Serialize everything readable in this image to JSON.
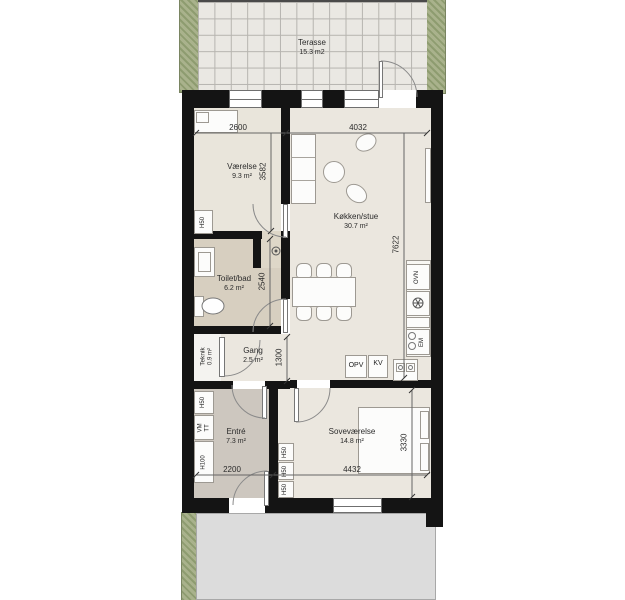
{
  "terrace": {
    "name": "Terasse",
    "area": "15.3 m2"
  },
  "rooms": {
    "vaerelse": {
      "name": "Værelse",
      "area": "9.3 m²"
    },
    "koekken": {
      "name": "Køkken/stue",
      "area": "30.7 m²"
    },
    "toilet": {
      "name": "Toilet/bad",
      "area": "6.2 m²"
    },
    "teknik": {
      "name": "Teknik",
      "area": "0.9 m²"
    },
    "gang": {
      "name": "Gang",
      "area": "2.5 m²"
    },
    "entre": {
      "name": "Entré",
      "area": "7.3 m²"
    },
    "sovevaerelse": {
      "name": "Soveværelse",
      "area": "14.8 m²"
    }
  },
  "dims": {
    "d2600": "2600",
    "d3582": "3582",
    "d4032": "4032",
    "d7622": "7622",
    "d2540": "2540",
    "d1300": "1300",
    "d2200": "2200",
    "d4432": "4432",
    "d3330": "3330"
  },
  "fixtures": {
    "h50": "H50",
    "h100": "H100",
    "vm": "VM",
    "tt": "TT",
    "ovn": "OVN",
    "em": "EM",
    "opv": "OPV",
    "kv": "KV"
  },
  "colors": {
    "wall": "#141414",
    "floor_main": "#eae6dd",
    "floor_toilet": "#d7cfc0",
    "floor_entre": "#cdc7bf",
    "floor_teknik": "#f4f3f0",
    "hedge_green": "#99a67b",
    "terrace_tile": "#eae8e3",
    "pavement": "#dcdcdc"
  }
}
